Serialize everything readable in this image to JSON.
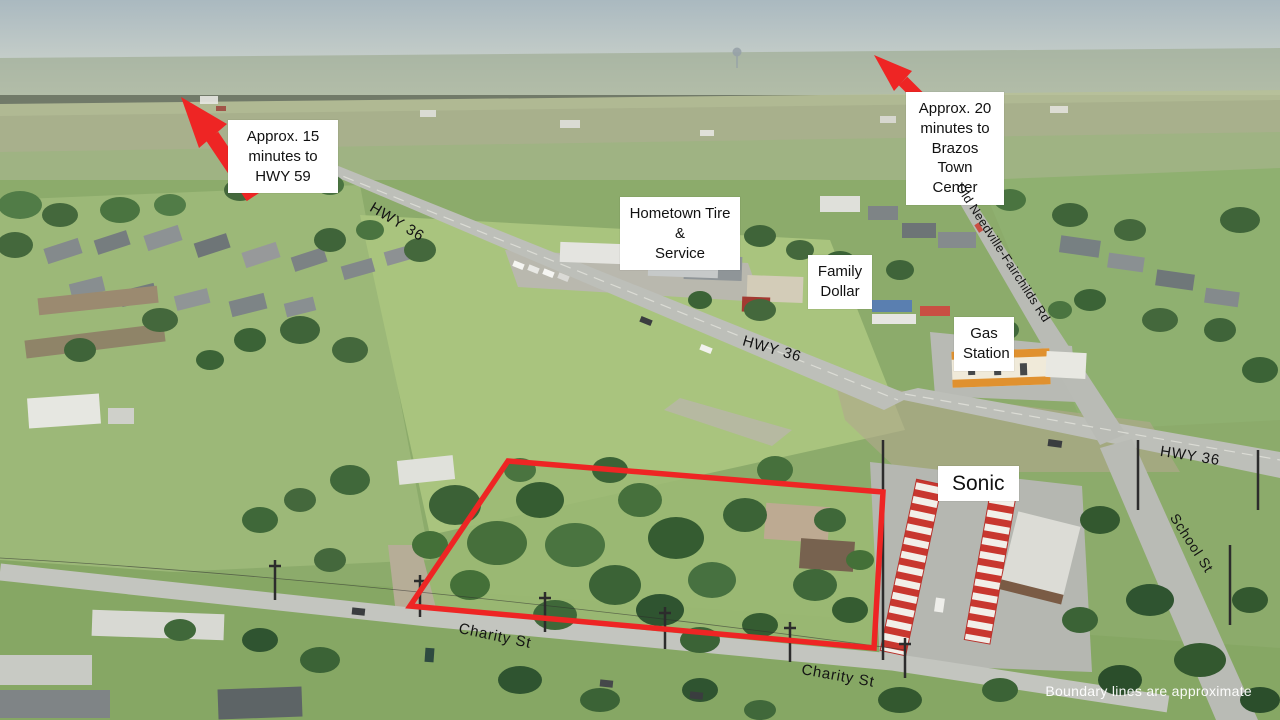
{
  "scene": {
    "description": "Aerial drone real-estate photo with property boundary and location annotations",
    "disclaimer": "Boundary lines are approximate"
  },
  "travel_callouts": [
    {
      "label": "Approx. 15\nminutes to\nHWY 59"
    },
    {
      "label": "Approx. 20\nminutes to\nBrazos Town\nCenter"
    }
  ],
  "poi_labels": {
    "hometown_tire": "Hometown Tire &\nService",
    "family_dollar": "Family\nDollar",
    "gas_station": "Gas\nStation",
    "sonic": "Sonic"
  },
  "road_labels": {
    "hwy36_top": "HWY 36",
    "hwy36_mid": "HWY 36",
    "hwy36_right": "HWY 36",
    "old_needville_fairchilds": "Old Needville-Fairchilds Rd",
    "school_st": "School St",
    "charity_st_west": "Charity St",
    "charity_st_east": "Charity St"
  },
  "colors": {
    "boundary_red": "#ee2524",
    "arrow_red": "#ee2524",
    "label_background": "#ffffff",
    "label_text": "#111111",
    "disclaimer_text": "#ffffff"
  }
}
